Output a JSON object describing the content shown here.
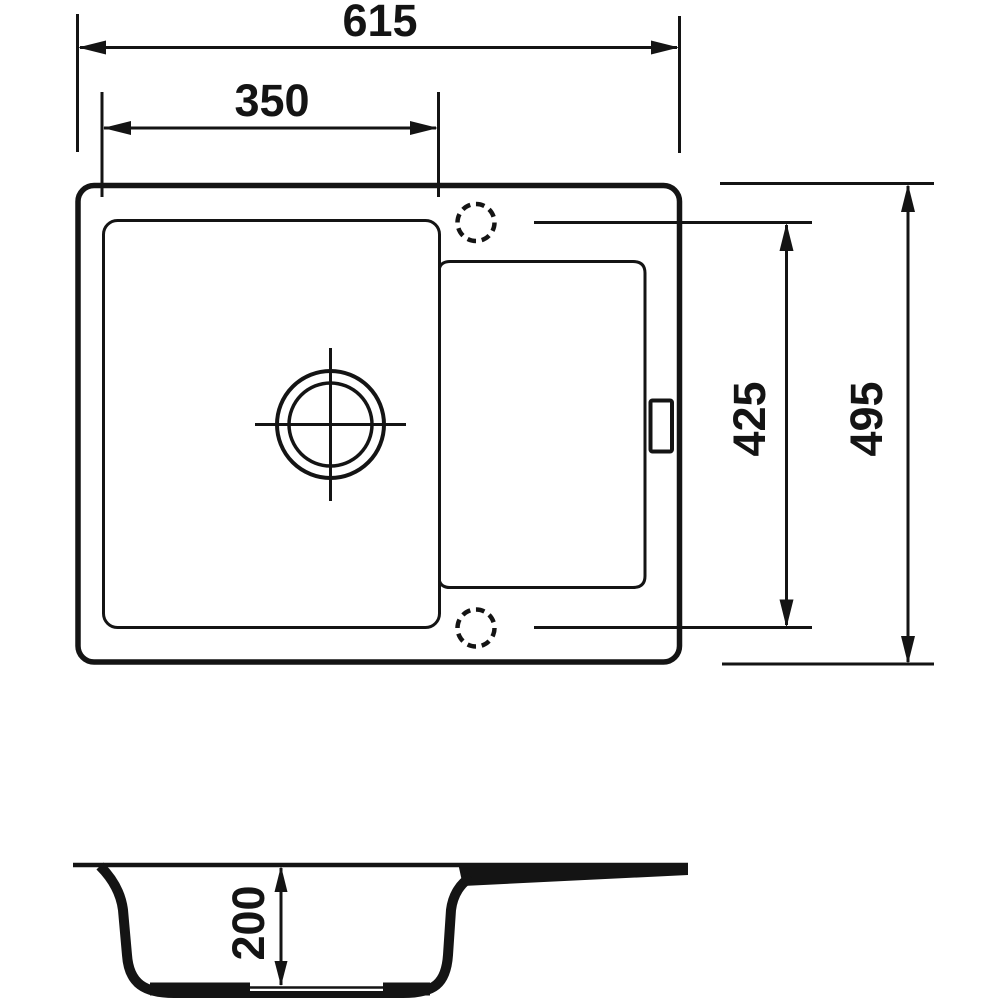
{
  "drawing": {
    "type": "technical-dimension-drawing",
    "subject": "kitchen-sink-with-drainboard",
    "colors": {
      "background": "#ffffff",
      "line": "#141414"
    },
    "views": {
      "plan": {
        "name": "top-view"
      },
      "section": {
        "name": "side-section-view"
      }
    }
  },
  "dimensions": {
    "overall_width": "615",
    "bowl_width": "350",
    "tap_hole_span": "425",
    "overall_depth": "495",
    "bowl_depth": "200"
  }
}
